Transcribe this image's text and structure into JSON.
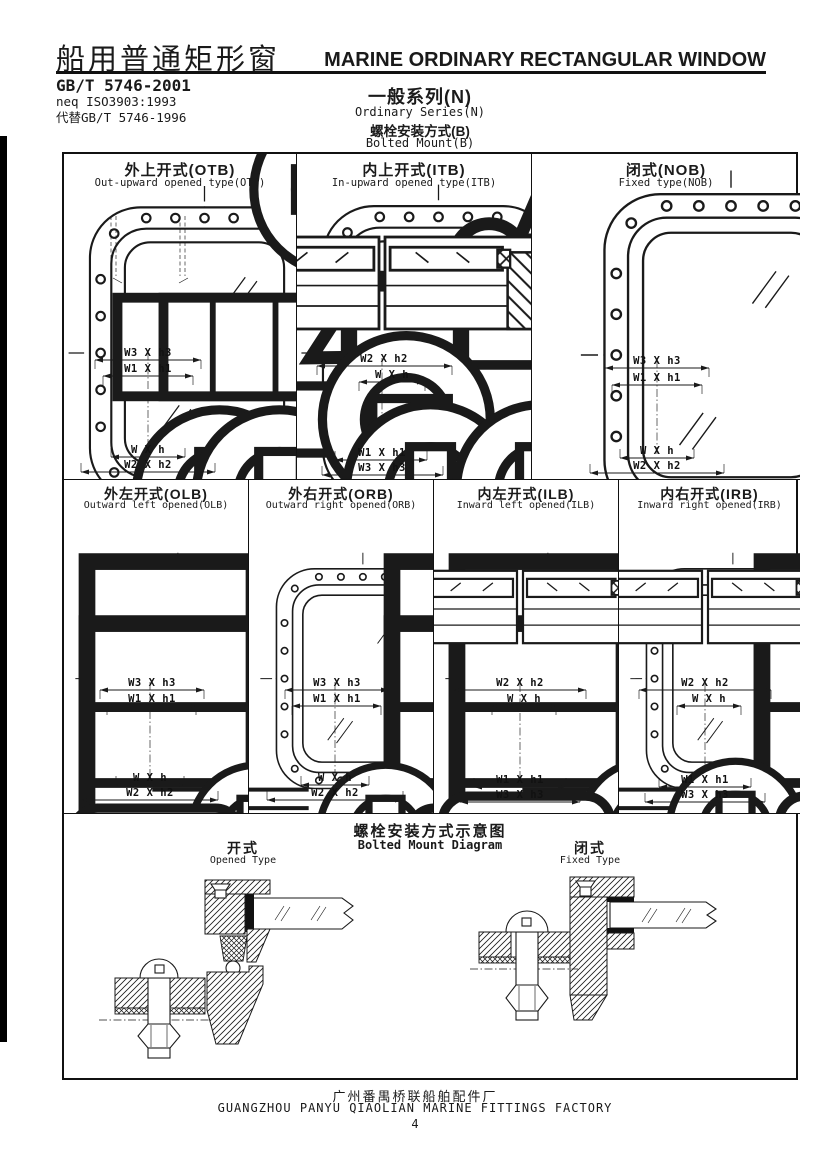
{
  "page": {
    "number": "4"
  },
  "header": {
    "title_cn": "船用普通矩形窗",
    "title_en": "MARINE ORDINARY RECTANGULAR WINDOW",
    "standard_code": "GB/T 5746-2001",
    "equivalence": "neq ISO3903:1993",
    "supersedes": "代替GB/T 5746-1996",
    "series_cn": "一般系列(N)",
    "series_en": "Ordinary Series(N)",
    "mount_cn": "螺栓安装方式(B)",
    "mount_en": "Bolted Mount(B)"
  },
  "cells": {
    "otb": {
      "title_cn": "外上开式(OTB)",
      "title_en": "Out-upward opened type(OTB)",
      "dims_top": [
        "W3 X h3",
        "W1 X h1"
      ],
      "dims_bottom": [
        "W X h",
        "W2 X h2"
      ]
    },
    "itb": {
      "title_cn": "内上开式(ITB)",
      "title_en": "In-upward opened type(ITB)",
      "dims_top": [
        "W2 X h2",
        "W X h"
      ],
      "dims_bottom": [
        "W1 X h1",
        "W3 X h3"
      ]
    },
    "nob": {
      "title_cn": "闭式(NOB)",
      "title_en": "Fixed type(NOB)",
      "dims_top": [
        "W3 X h3",
        "W1 X h1"
      ],
      "dims_bottom": [
        "W X h",
        "W2 X h2"
      ]
    },
    "olb": {
      "title_cn": "外左开式(OLB)",
      "title_en": "Outward left opened(OLB)",
      "dims_top": [
        "W3 X h3",
        "W1 X h1"
      ],
      "dims_bottom": [
        "W X h",
        "W2 X h2"
      ]
    },
    "orb": {
      "title_cn": "外右开式(ORB)",
      "title_en": "Outward right opened(ORB)",
      "dims_top": [
        "W3 X h3",
        "W1 X h1"
      ],
      "dims_bottom": [
        "W X h",
        "W2 X h2"
      ]
    },
    "ilb": {
      "title_cn": "内左开式(ILB)",
      "title_en": "Inward left opened(ILB)",
      "dims_top": [
        "W2 X h2",
        "W X h"
      ],
      "dims_bottom": [
        "W1 X h1",
        "W3 X h3"
      ]
    },
    "irb": {
      "title_cn": "内右开式(IRB)",
      "title_en": "Inward right opened(IRB)",
      "dims_top": [
        "W2 X h2",
        "W X h"
      ],
      "dims_bottom": [
        "W1 X h1",
        "W3 X h3"
      ]
    }
  },
  "mount_diagram": {
    "title_cn": "螺栓安装方式示意图",
    "title_en": "Bolted Mount Diagram",
    "opened_label_cn": "开式",
    "opened_label_en": "Opened Type",
    "fixed_label_cn": "闭式",
    "fixed_label_en": "Fixed Type"
  },
  "footer": {
    "factory_cn": "广州番禺桥联船舶配件厂",
    "factory_en": "GUANGZHOU PANYU QIAOLIAN MARINE FITTINGS FACTORY"
  },
  "colors": {
    "ink": "#1a1a1a",
    "paper": "#ffffff"
  }
}
